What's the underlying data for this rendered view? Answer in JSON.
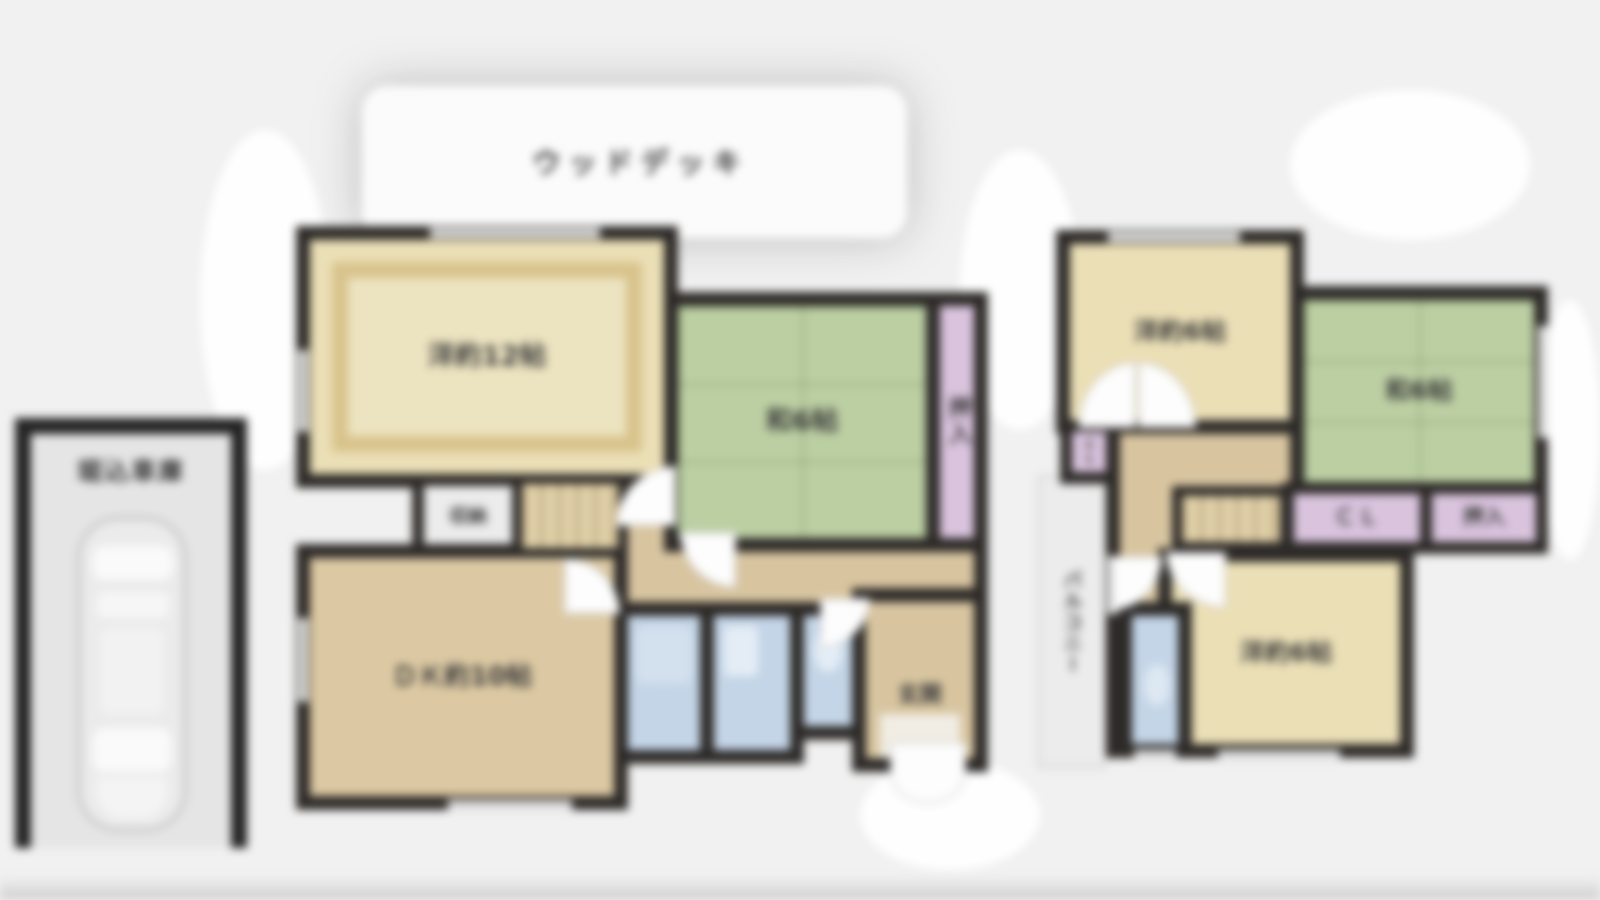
{
  "plan": {
    "wood_deck": {
      "label": "ウッドデッキ"
    },
    "garage": {
      "label": "堀込車庫"
    },
    "floor1": {
      "western_room": {
        "label": "洋約12帖"
      },
      "japanese_room": {
        "label": "和6帖"
      },
      "oshiire": {
        "label": "押入"
      },
      "storage": {
        "label": "収納"
      },
      "dining_kitchen": {
        "label": "ＤＫ約10帖"
      },
      "entrance": {
        "label": "玄関"
      }
    },
    "floor2": {
      "western_room_upper": {
        "label": "洋約6帖"
      },
      "japanese_room": {
        "label": "和6帖"
      },
      "closet": {
        "label": "ＣＬ"
      },
      "closet_small": {
        "label": "CL"
      },
      "oshiire": {
        "label": "押入"
      },
      "balcony": {
        "label": "バルコニー"
      },
      "western_room_lower": {
        "label": "洋約6帖"
      }
    }
  },
  "colors": {
    "wall": "#2d2a28",
    "western_room": "#ebdfb6",
    "rug_border": "#d8c38c",
    "tatami_green": "#bccfa3",
    "closet_lavender": "#d9c3dd",
    "floor_tan": "#d8c5a0",
    "water_blue": "#c4d5e7",
    "deck_white": "#fbfbfb",
    "garage_gray": "#e5e5e5",
    "background": "#f1f1f1",
    "label_text": "#3a3a3a"
  }
}
